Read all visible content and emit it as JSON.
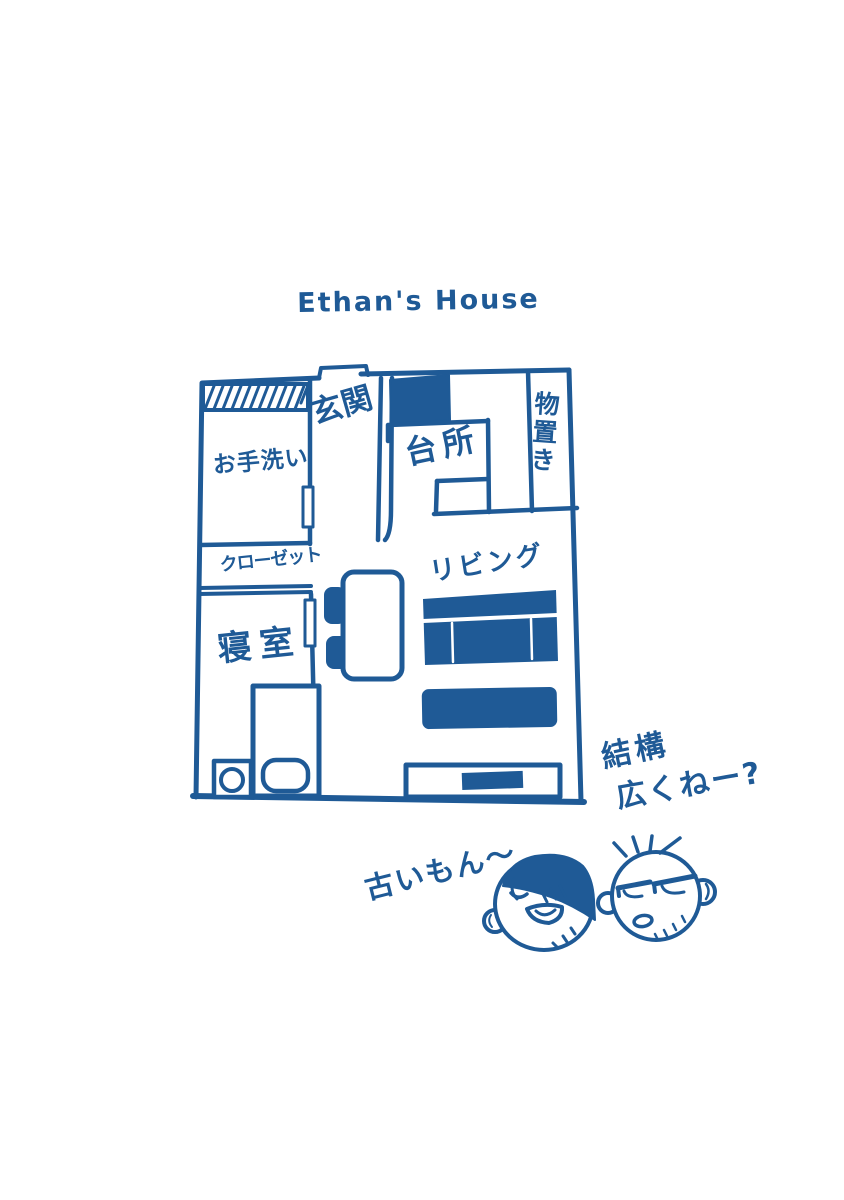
{
  "canvas": {
    "background": "#ffffff",
    "ink": "#1f5a96"
  },
  "title": "Ethan's House",
  "floor_plan": {
    "rooms": {
      "entrance": {
        "label": "玄関"
      },
      "toilet": {
        "label": "お手洗い"
      },
      "closet": {
        "label": "クローゼット"
      },
      "bedroom": {
        "label": "寝室"
      },
      "kitchen": {
        "label": "台所"
      },
      "storage": {
        "label": "物置き"
      },
      "living": {
        "label": "リビング"
      }
    }
  },
  "comments": {
    "spacious_line1": "結構",
    "spacious_line2": "広くねー?",
    "old_reply": "古いもん〜"
  },
  "characters": {
    "left_face": "tongue-out-face",
    "right_face": "unimpressed-face"
  }
}
